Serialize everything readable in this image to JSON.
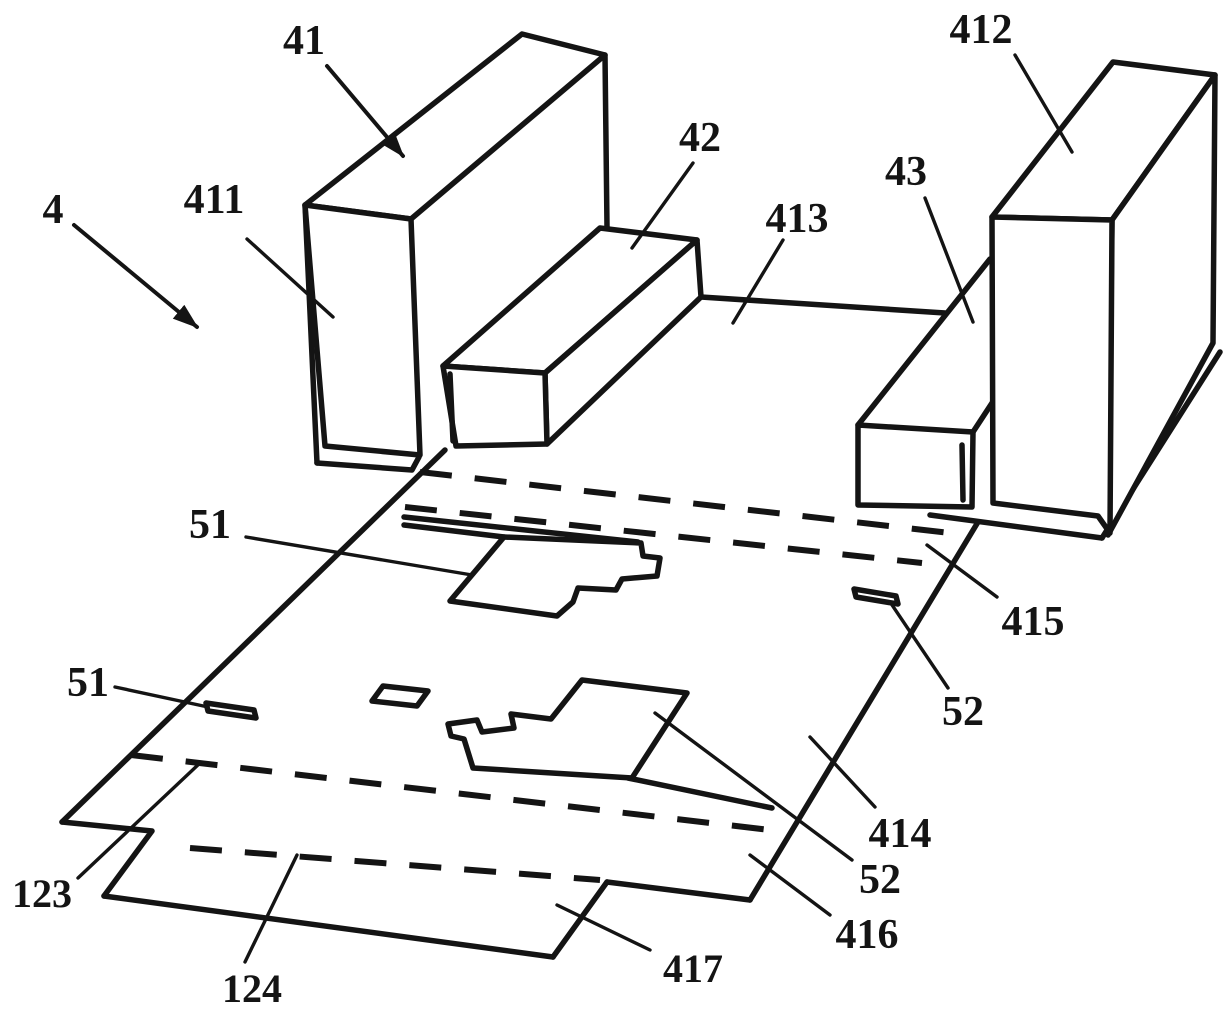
{
  "figure": {
    "kind": "patent-line-drawing",
    "background_color": "#ffffff",
    "line_color": "#141414",
    "labels": [
      {
        "id": "ref-4",
        "text": "4"
      },
      {
        "id": "ref-41",
        "text": "41"
      },
      {
        "id": "ref-411",
        "text": "411"
      },
      {
        "id": "ref-42",
        "text": "42"
      },
      {
        "id": "ref-413",
        "text": "413"
      },
      {
        "id": "ref-412",
        "text": "412"
      },
      {
        "id": "ref-43",
        "text": "43"
      },
      {
        "id": "ref-51-upper",
        "text": "51"
      },
      {
        "id": "ref-51-lower",
        "text": "51"
      },
      {
        "id": "ref-415",
        "text": "415"
      },
      {
        "id": "ref-52-upper",
        "text": "52"
      },
      {
        "id": "ref-414",
        "text": "414"
      },
      {
        "id": "ref-52-lower",
        "text": "52"
      },
      {
        "id": "ref-416",
        "text": "416"
      },
      {
        "id": "ref-123",
        "text": "123"
      },
      {
        "id": "ref-124",
        "text": "124"
      },
      {
        "id": "ref-417",
        "text": "417"
      }
    ]
  }
}
